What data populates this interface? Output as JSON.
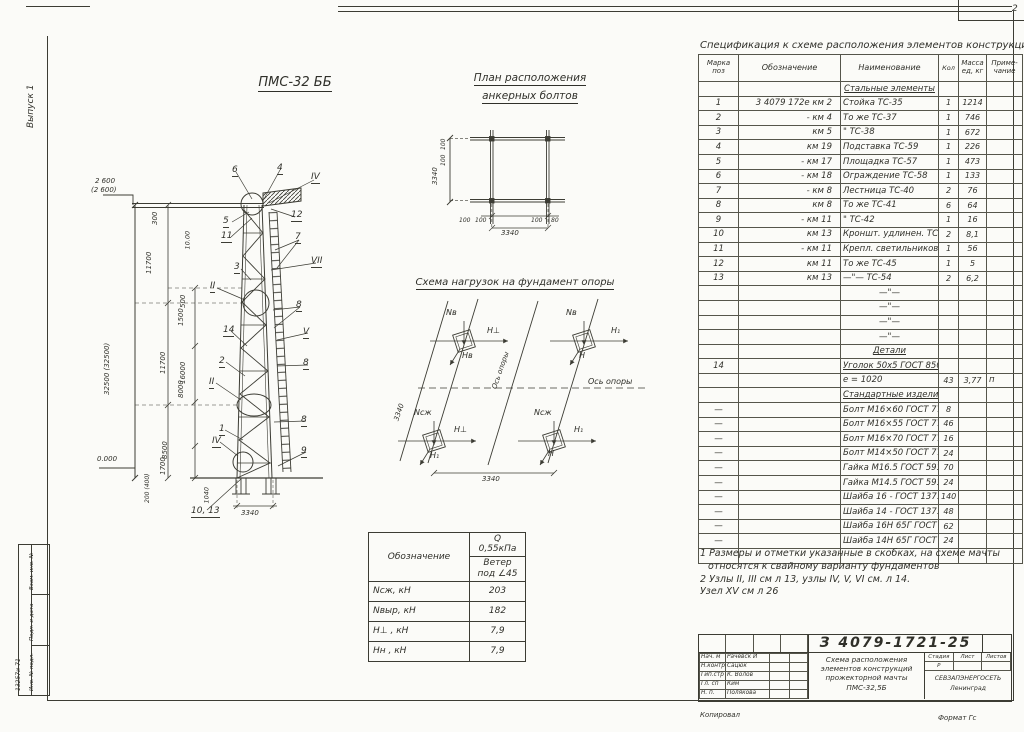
{
  "page": {
    "corner_number": "2",
    "edition": "Выпуск 1",
    "footer_left": "Копировал",
    "footer_right": "Формат Гс",
    "ink_color": "#30302a",
    "margin_stamp": {
      "f1": "Взам. инв. №",
      "f2": "Подп. и дата",
      "f3": "Инв. № подл.",
      "number": "13257и-71"
    }
  },
  "drawing": {
    "mast_title": "ПМС-32 ББ",
    "plan_title_1": "План расположения",
    "plan_title_2": "анкерных болтов",
    "loads_title": "Схема нагрузок на фундамент опоры",
    "mast_labels": [
      {
        "t": "6",
        "x": 177,
        "y": 66,
        "cls": "co"
      },
      {
        "t": "4",
        "x": 222,
        "y": 64,
        "cls": "co"
      },
      {
        "t": "IV",
        "x": 256,
        "y": 73,
        "cls": "co"
      },
      {
        "t": "12",
        "x": 236,
        "y": 111,
        "cls": "co"
      },
      {
        "t": "5",
        "x": 168,
        "y": 117,
        "cls": "co"
      },
      {
        "t": "11",
        "x": 166,
        "y": 132,
        "cls": "co"
      },
      {
        "t": "7",
        "x": 240,
        "y": 133,
        "cls": "co"
      },
      {
        "t": "VII",
        "x": 256,
        "y": 157,
        "cls": "co"
      },
      {
        "t": "3",
        "x": 179,
        "y": 163,
        "cls": "co"
      },
      {
        "t": "II",
        "x": 155,
        "y": 182,
        "cls": "co"
      },
      {
        "t": "8",
        "x": 241,
        "y": 201,
        "cls": "co"
      },
      {
        "t": "14",
        "x": 168,
        "y": 226,
        "cls": "co"
      },
      {
        "t": "V",
        "x": 248,
        "y": 228,
        "cls": "co"
      },
      {
        "t": "2",
        "x": 164,
        "y": 257,
        "cls": "co"
      },
      {
        "t": "8",
        "x": 248,
        "y": 259,
        "cls": "co"
      },
      {
        "t": "II",
        "x": 154,
        "y": 278,
        "cls": "co"
      },
      {
        "t": "8",
        "x": 246,
        "y": 316,
        "cls": "co"
      },
      {
        "t": "1",
        "x": 164,
        "y": 325,
        "cls": "co"
      },
      {
        "t": "IV",
        "x": 157,
        "y": 337,
        "cls": "co"
      },
      {
        "t": "9",
        "x": 246,
        "y": 347,
        "cls": "co"
      },
      {
        "t": "10, 13",
        "x": 136,
        "y": 407,
        "cls": "co"
      },
      {
        "t": "2 600",
        "x": 40,
        "y": 78,
        "cls": "dim"
      },
      {
        "t": "(2 600)",
        "x": 36,
        "y": 87,
        "cls": "dim"
      },
      {
        "t": "32500 (32500)",
        "x": 56,
        "y": 288,
        "r": -90,
        "cls": "dim"
      },
      {
        "t": "300",
        "x": 104,
        "y": 118,
        "r": -90,
        "cls": "dim"
      },
      {
        "t": "11700",
        "x": 98,
        "y": 167,
        "r": -90,
        "cls": "dim"
      },
      {
        "t": "10.00",
        "x": 136,
        "y": 143,
        "r": -90,
        "cls": "dim",
        "fs": 6.5
      },
      {
        "t": "500",
        "x": 132,
        "y": 201,
        "r": -90,
        "cls": "dim"
      },
      {
        "t": "1500",
        "x": 130,
        "y": 219,
        "r": -90,
        "cls": "dim"
      },
      {
        "t": "11700",
        "x": 112,
        "y": 267,
        "r": -90,
        "cls": "dim"
      },
      {
        "t": "16000",
        "x": 132,
        "y": 277,
        "r": -90,
        "cls": "dim"
      },
      {
        "t": "8000",
        "x": 130,
        "y": 291,
        "r": -90,
        "cls": "dim"
      },
      {
        "t": "8500",
        "x": 114,
        "y": 352,
        "r": -90,
        "cls": "dim"
      },
      {
        "t": "1700",
        "x": 112,
        "y": 368,
        "r": -90,
        "cls": "dim"
      },
      {
        "t": "1040",
        "x": 155,
        "y": 397,
        "r": -90,
        "cls": "dim",
        "fs": 6.5
      },
      {
        "t": "200 (400)",
        "x": 96,
        "y": 397,
        "r": -90,
        "cls": "dim",
        "fs": 6
      },
      {
        "t": "0.000",
        "x": 42,
        "y": 356,
        "cls": "dim"
      },
      {
        "t": "3340",
        "x": 186,
        "y": 410,
        "cls": "dim"
      }
    ],
    "plan_labels": [
      {
        "t": "3340",
        "x": 14,
        "y": 50,
        "r": -90,
        "cls": "dim"
      },
      {
        "t": "100",
        "x": 22,
        "y": 16,
        "r": -90,
        "cls": "dim",
        "fs": 6
      },
      {
        "t": "100",
        "x": 22,
        "y": 32,
        "r": -90,
        "cls": "dim",
        "fs": 6
      },
      {
        "t": "100",
        "x": 34,
        "y": 90,
        "cls": "dim",
        "fs": 6
      },
      {
        "t": "100",
        "x": 50,
        "y": 90,
        "cls": "dim",
        "fs": 6
      },
      {
        "t": "100",
        "x": 106,
        "y": 90,
        "cls": "dim",
        "fs": 6
      },
      {
        "t": "80",
        "x": 126,
        "y": 90,
        "cls": "dim",
        "fs": 6
      },
      {
        "t": "3340",
        "x": 76,
        "y": 102,
        "cls": "dim"
      }
    ],
    "loads_labels": [
      {
        "t": "Nв",
        "x": 56,
        "y": 14,
        "cls": "ld"
      },
      {
        "t": "H⊥",
        "x": 97,
        "y": 32,
        "cls": "ld"
      },
      {
        "t": "Hв",
        "x": 72,
        "y": 57,
        "cls": "ld"
      },
      {
        "t": "Nв",
        "x": 176,
        "y": 14,
        "cls": "ld"
      },
      {
        "t": "H₁",
        "x": 221,
        "y": 32,
        "cls": "ld"
      },
      {
        "t": "H",
        "x": 189,
        "y": 57,
        "cls": "ld"
      },
      {
        "t": "Ось опоры",
        "x": 108,
        "y": 88,
        "r": -71,
        "cls": "dim"
      },
      {
        "t": "Ось опоры",
        "x": 198,
        "y": 83,
        "cls": "ld"
      },
      {
        "t": "Nсж",
        "x": 24,
        "y": 114,
        "cls": "ld"
      },
      {
        "t": "H⊥",
        "x": 64,
        "y": 131,
        "cls": "ld"
      },
      {
        "t": "H₁",
        "x": 40,
        "y": 157,
        "cls": "ld"
      },
      {
        "t": "Nсж",
        "x": 144,
        "y": 114,
        "cls": "ld"
      },
      {
        "t": "H₁",
        "x": 184,
        "y": 131,
        "cls": "ld"
      },
      {
        "t": "H",
        "x": 158,
        "y": 155,
        "cls": "ld"
      },
      {
        "t": "3340",
        "x": 10,
        "y": 120,
        "r": -71,
        "cls": "dim"
      },
      {
        "t": "3340",
        "x": 92,
        "y": 181,
        "cls": "dim"
      }
    ]
  },
  "load_table": {
    "h_sym": "Обозначение",
    "h_q": "Q 0,55кПа",
    "h_wind": "Ветер под ∠45",
    "rows": [
      {
        "l": "Nсж, кН",
        "v": "203"
      },
      {
        "l": "Nвыр, кН",
        "v": "182"
      },
      {
        "l": "H⊥ , кН",
        "v": "7,9"
      },
      {
        "l": "Hн , кН",
        "v": "7,9"
      }
    ]
  },
  "spec": {
    "title": "Спецификация к схеме расположения элементов конструкций",
    "h_mark1": "Марка",
    "h_mark2": "поз",
    "h_desig": "Обозначение",
    "h_name": "Наименование",
    "h_qty": "Кол",
    "h_mass1": "Масса",
    "h_mass2": "ед, кг",
    "h_note1": "Приме-",
    "h_note2": "чание",
    "rows": [
      {
        "n": "Стальные элементы",
        "cls": "sec"
      },
      {
        "m": "1",
        "o": "3 4079 172е км 2",
        "n": "Стойка   ТС-35",
        "k": "1",
        "w": "1214"
      },
      {
        "m": "2",
        "o": "- км 4",
        "n": "То же   ТС-37",
        "k": "1",
        "w": "746"
      },
      {
        "m": "3",
        "o": "км 5",
        "n": "\"   ТС-38",
        "k": "1",
        "w": "672"
      },
      {
        "m": "4",
        "o": "км 19",
        "n": "Подставка ТС-59",
        "k": "1",
        "w": "226"
      },
      {
        "m": "5",
        "o": "- км 17",
        "n": "Площадка ТС-57",
        "k": "1",
        "w": "473"
      },
      {
        "m": "6",
        "o": "- км 18",
        "n": "Ограждение ТС-58",
        "k": "1",
        "w": "133"
      },
      {
        "m": "7",
        "o": "- км 8",
        "n": "Лестница  ТС-40",
        "k": "2",
        "w": "76"
      },
      {
        "m": "8",
        "o": "км 8",
        "n": "То же   ТС-41",
        "k": "6",
        "w": "64"
      },
      {
        "m": "9",
        "o": "- км 11",
        "n": "\"   ТС-42",
        "k": "1",
        "w": "16"
      },
      {
        "m": "10",
        "o": "км 13",
        "n": "Кроншт. удлинен. ТС-53",
        "k": "2",
        "w": "8,1"
      },
      {
        "m": "11",
        "o": "- км 11",
        "n": "Крепл. светильников ТС-44",
        "k": "1",
        "w": "56"
      },
      {
        "m": "12",
        "o": "км 11",
        "n": "То же   ТС-45",
        "k": "1",
        "w": "5"
      },
      {
        "m": "13",
        "o": "км 13",
        "n": "—\"—   ТС-54",
        "k": "2",
        "w": "6,2"
      },
      {
        "n": "—\"—",
        "cls": "ctr"
      },
      {
        "n": "—\"—",
        "cls": "ctr"
      },
      {
        "n": "—\"—",
        "cls": "ctr"
      },
      {
        "n": "—\"—",
        "cls": "ctr"
      },
      {
        "n": "Детали",
        "cls": "sec"
      },
      {
        "m": "14",
        "n": "Уголок 50х5 ГОСТ 8509-86",
        "cls": "ul"
      },
      {
        "n": "е = 1020",
        "k": "43",
        "w": "3,77",
        "p": "п"
      },
      {
        "n": "Стандартные изделия",
        "cls": "sec"
      },
      {
        "m": "—",
        "n": "Болт М16×60 ГОСТ 7798-70",
        "k": "8"
      },
      {
        "m": "—",
        "n": "Болт М16×55 ГОСТ 7798-70",
        "k": "46"
      },
      {
        "m": "—",
        "n": "Болт М16×70 ГОСТ 7798-70",
        "k": "16"
      },
      {
        "m": "—",
        "n": "Болт М14×50 ГОСТ 7798-70",
        "k": "24"
      },
      {
        "m": "—",
        "n": "Гайка М16.5 ГОСТ 5915-70",
        "k": "70"
      },
      {
        "m": "—",
        "n": "Гайка М14.5 ГОСТ 5915-70",
        "k": "24"
      },
      {
        "m": "—",
        "n": "Шайба 16 - ГОСТ 1371-78",
        "k": "140"
      },
      {
        "m": "—",
        "n": "Шайба 14 - ГОСТ 1371-78",
        "k": "48"
      },
      {
        "m": "—",
        "n": "Шайба 16Н 65Г ГОСТ 6402-70",
        "k": "62"
      },
      {
        "m": "—",
        "n": "Шайба 14Н 65Г ГОСТ 6402-70",
        "k": "24"
      },
      {}
    ]
  },
  "notes": {
    "n1": "1 Размеры и отметки указанные в скобках, на схеме мачты относятся к свайному варианту фундаментов",
    "n2": "2 Узлы II, III см л 13, узлы IV, V, VI см. л 14.",
    "n3": "Узел XV см л 26"
  },
  "titleblock": {
    "doc_number": "З 4079-1721-25",
    "t1": "Схема расположения",
    "t2": "элементов конструкций",
    "t3": "прожекторной мачты",
    "t4": "ПМС-32,5Б",
    "stage_label": "Стадия",
    "sheet_label": "Лист",
    "sheets_label": "Листов",
    "stage": "Р",
    "org": "СЕВЗАПЭНЕРГОСЕТЬ",
    "city": "Ленинград",
    "people": [
      {
        "role": "Нач. м",
        "name": "Рачевск И"
      },
      {
        "role": "Н.контр",
        "name": "Сацюк"
      },
      {
        "role": "Гип.стр",
        "name": "К. Волов"
      },
      {
        "role": "Гл. сп",
        "name": "Ким"
      },
      {
        "role": "Н. п.",
        "name": "Полякова"
      }
    ]
  }
}
